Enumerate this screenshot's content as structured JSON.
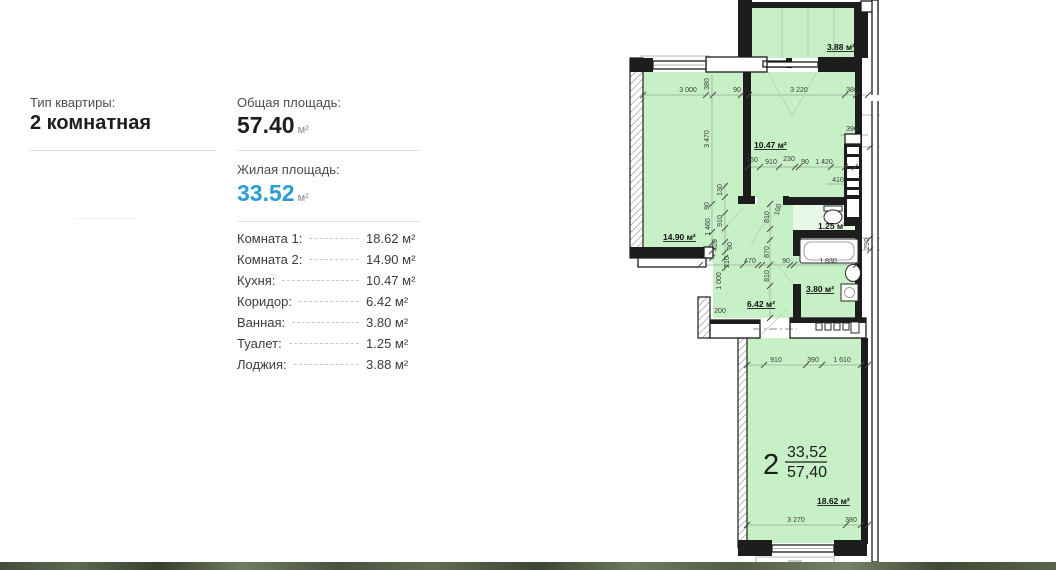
{
  "panel": {
    "type_label": "Тип квартиры:",
    "type_value": "2 комнатная",
    "total_label": "Общая площадь:",
    "total_value": "57.40",
    "total_unit": "м²",
    "living_label": "Жилая площадь:",
    "living_value": "33.52",
    "living_unit": "м²",
    "accent_color": "#2b9cd8",
    "rooms": [
      {
        "label": "Комната 1:",
        "value": "18.62 м²"
      },
      {
        "label": "Комната 2:",
        "value": "14.90 м²"
      },
      {
        "label": "Кухня:",
        "value": "10.47 м²"
      },
      {
        "label": "Коридор:",
        "value": "6.42 м²"
      },
      {
        "label": "Ванная:",
        "value": "3.80 м²"
      },
      {
        "label": "Туалет:",
        "value": "1.25 м²"
      },
      {
        "label": "Лоджия:",
        "value": "3.88 м²"
      }
    ]
  },
  "plan": {
    "colors": {
      "room_fill": "#c7f0c6",
      "room_fill_pale": "#e7f8e7",
      "wall": "#1d1d1d",
      "dim_text": "#3a3a3a",
      "guide_line": "#95a795"
    },
    "unit_label": {
      "number": "2",
      "upper": "33,52",
      "lower": "57,40"
    },
    "room_labels": [
      {
        "text": "3.88 м²",
        "x": 855,
        "y": 50,
        "anchor": "end"
      },
      {
        "text": "14.90 м²",
        "x": 663,
        "y": 240,
        "anchor": "start"
      },
      {
        "text": "10.47 м²",
        "x": 754,
        "y": 148,
        "anchor": "start"
      },
      {
        "text": "1.25 м²",
        "x": 818,
        "y": 229,
        "anchor": "start"
      },
      {
        "text": "3.80 м²",
        "x": 806,
        "y": 292,
        "anchor": "start"
      },
      {
        "text": "6.42 м²",
        "x": 747,
        "y": 307,
        "anchor": "start"
      },
      {
        "text": "18.62 м²",
        "x": 817,
        "y": 504,
        "anchor": "start"
      }
    ],
    "dimensions": [
      {
        "t": "3 000",
        "x": 688,
        "y": 92
      },
      {
        "t": "380",
        "x": 709,
        "y": 84,
        "r": -90
      },
      {
        "t": "90",
        "x": 737,
        "y": 92
      },
      {
        "t": "3 220",
        "x": 799,
        "y": 92
      },
      {
        "t": "380",
        "x": 852,
        "y": 92
      },
      {
        "t": "3 470",
        "x": 709,
        "y": 139,
        "r": -90
      },
      {
        "t": "390",
        "x": 852,
        "y": 131
      },
      {
        "t": "160",
        "x": 752,
        "y": 162
      },
      {
        "t": "910",
        "x": 771,
        "y": 164
      },
      {
        "t": "230",
        "x": 789,
        "y": 161
      },
      {
        "t": "90",
        "x": 805,
        "y": 164
      },
      {
        "t": "1 420",
        "x": 824,
        "y": 164
      },
      {
        "t": "410",
        "x": 838,
        "y": 182
      },
      {
        "t": "130",
        "x": 722,
        "y": 190,
        "r": -90
      },
      {
        "t": "90",
        "x": 709,
        "y": 206,
        "r": -90
      },
      {
        "t": "910",
        "x": 722,
        "y": 221,
        "r": -90
      },
      {
        "t": "1 460",
        "x": 710,
        "y": 227,
        "r": -90
      },
      {
        "t": "420",
        "x": 717,
        "y": 245,
        "r": -90
      },
      {
        "t": "90",
        "x": 732,
        "y": 246,
        "r": -90
      },
      {
        "t": "210",
        "x": 729,
        "y": 262,
        "r": -90
      },
      {
        "t": "100",
        "x": 780,
        "y": 210,
        "r": -75
      },
      {
        "t": "810",
        "x": 769,
        "y": 217,
        "r": -90
      },
      {
        "t": "870",
        "x": 769,
        "y": 252,
        "r": -90
      },
      {
        "t": "810",
        "x": 769,
        "y": 276,
        "r": -90
      },
      {
        "t": "470",
        "x": 750,
        "y": 263
      },
      {
        "t": "90",
        "x": 786,
        "y": 263
      },
      {
        "t": "1 830",
        "x": 828,
        "y": 263
      },
      {
        "t": "1 000",
        "x": 721,
        "y": 281,
        "r": -90
      },
      {
        "t": "200",
        "x": 720,
        "y": 313
      },
      {
        "t": "290",
        "x": 869,
        "y": 244,
        "r": -90
      },
      {
        "t": "910",
        "x": 776,
        "y": 362
      },
      {
        "t": "390",
        "x": 813,
        "y": 362
      },
      {
        "t": "1 610",
        "x": 842,
        "y": 362
      },
      {
        "t": "3 270",
        "x": 796,
        "y": 522
      },
      {
        "t": "380",
        "x": 851,
        "y": 522
      }
    ]
  }
}
